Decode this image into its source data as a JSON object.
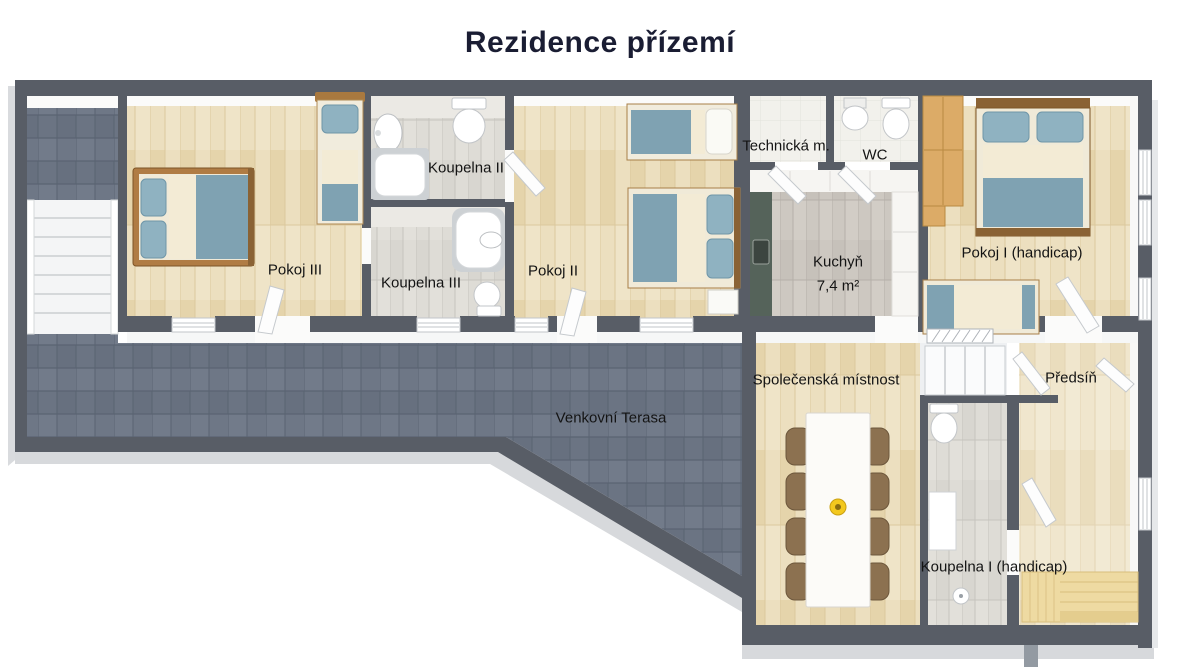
{
  "title": "Rezidence přízemí",
  "rooms": [
    {
      "id": "pokoj-iii",
      "label": "Pokoj III"
    },
    {
      "id": "koupelna-ii",
      "label": "Koupelna II"
    },
    {
      "id": "koupelna-iii",
      "label": "Koupelna III"
    },
    {
      "id": "pokoj-ii",
      "label": "Pokoj II"
    },
    {
      "id": "technicka",
      "label": "Technická m."
    },
    {
      "id": "wc",
      "label": "WC"
    },
    {
      "id": "kuchyn",
      "label": "Kuchyň",
      "area": "7,4 m²"
    },
    {
      "id": "pokoj-i",
      "label": "Pokoj I (handicap)"
    },
    {
      "id": "spolecenska",
      "label": "Společenská místnost"
    },
    {
      "id": "predsin",
      "label": "Předsíň"
    },
    {
      "id": "terasa",
      "label": "Venkovní Terasa"
    },
    {
      "id": "koupelna-i",
      "label": "Koupelna I (handicap)"
    }
  ],
  "palette": {
    "wall": "#585d66",
    "wood_floor": "#ecdfbf",
    "terrace_tile": "#6b7483",
    "bath_tile": "#dedcd6",
    "kitchen_tile": "#cdc8c1",
    "counter_green": "#55635a",
    "bed_blanket_teal": "#7fa2b2",
    "bed_sheet_cream": "#f3ebd5",
    "bed_frame_wood": "#a87f48",
    "chair_brown": "#8c7150",
    "sauna_wood": "#eedaa2",
    "decor_yellow": "#f3c81e",
    "title_color": "#1a1d33"
  }
}
